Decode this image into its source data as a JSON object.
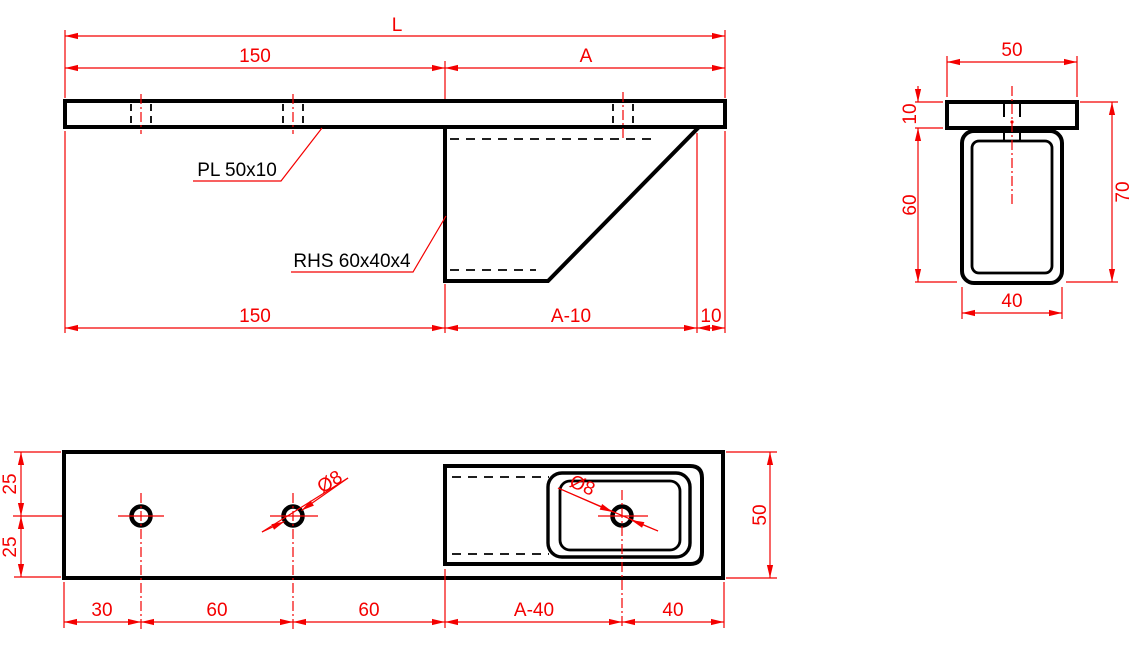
{
  "drawing_type": "fabrication-drawing-bracket",
  "colors": {
    "dimension": "#f40000",
    "geometry": "#000000",
    "background": "#ffffff"
  },
  "side_view": {
    "dim_L": "L",
    "dim_150_top": "150",
    "dim_A": "A",
    "label_plate": "PL 50x10",
    "label_rhs": "RHS 60x40x4",
    "dim_150_bottom": "150",
    "dim_A_minus_10": "A-10",
    "dim_10": "10"
  },
  "section_view": {
    "dim_50": "50",
    "dim_10": "10",
    "dim_60": "60",
    "dim_70": "70",
    "dim_40": "40"
  },
  "plan_view": {
    "dim_25_top": "25",
    "dim_25_bottom": "25",
    "dim_50": "50",
    "dia_left": "Ø8",
    "dia_right": "Ø8",
    "dim_30": "30",
    "dim_60_a": "60",
    "dim_60_b": "60",
    "dim_A_minus_40": "A-40",
    "dim_40": "40"
  }
}
